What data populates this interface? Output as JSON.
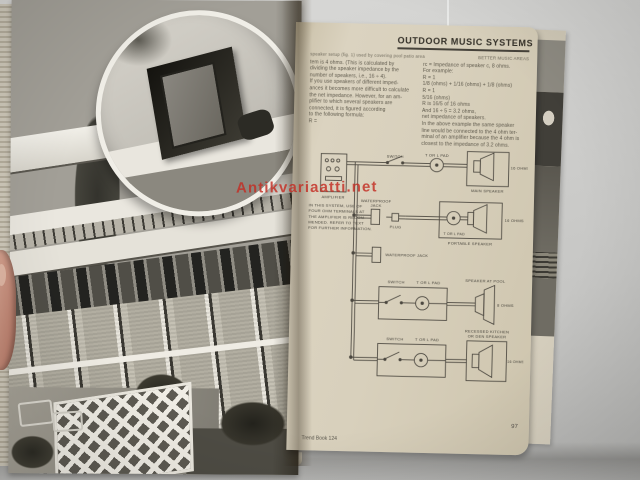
{
  "watermark": {
    "text": "Antikvariaatti.net",
    "color": "#c0352b"
  },
  "colors": {
    "paper": "#d8d0bc",
    "ink": "#4c4840",
    "photo_gray": "#a29f97",
    "backdrop": "#cdcdcb"
  },
  "right_page": {
    "title": "OUTDOOR MUSIC SYSTEMS",
    "caption_left": "speaker setup (fig. 1) used by covering pool patio area",
    "caption_right": "BETTER MUSIC AREAS",
    "col_left": [
      "tem is 4 ohms. (This is calculated by",
      "dividing the speaker impedance by the",
      "number of speakers, i.e., 16 ÷ 4).",
      "If you use speakers of different imped-",
      "ances it becomes more difficult to calculate",
      "the net impedance. However, for an am-",
      "plifier to which several speakers are",
      "connected, it is figured according",
      "to the following formula:",
      "R ="
    ],
    "col_right": [
      "rc = Impedance of speaker c, 8 ohms.",
      "For example:",
      "R =              1",
      "     1/8 (ohms) + 1/16 (ohms) + 1/8 (ohms)",
      "R =              1",
      "           5/16 (ohms)",
      "R is 16/5 of 16 ohms",
      "And 16 ÷ 5 = 3.2 ohms,",
      "net impedance of speakers.",
      "In the above example the same speaker",
      "line would be connected to the 4 ohm ter-",
      "minal of an amplifier because the 4 ohm is",
      "closest to the impedance of 3.2 ohms."
    ],
    "diagram": {
      "note_lines": [
        "IN THIS SYSTEM, USE OF",
        "FOUR OHM TERMINALS AT",
        "THE AMPLIFIER IS RECOM-",
        "MENDED. REFER TO TEXT",
        "FOR FURTHER INFORMATION."
      ],
      "amplifier": "AMPLIFIER",
      "switch": "SWITCH",
      "pad": "T OR L PAD",
      "main_speaker": "MAIN SPEAKER",
      "main_ohms": "16 OHMS",
      "jack_line1": "WATERPROOF",
      "jack_line2": "JACK",
      "jack": "WATERPROOF JACK",
      "plug": "PLUG",
      "portable_speaker": "PORTABLE SPEAKER",
      "portable_ohms": "16 OHMS",
      "pool_speaker": "SPEAKER AT POOL",
      "pool_ohms": "8 OHMS",
      "kitchen_speaker_1": "RECESSED KITCHEN",
      "kitchen_speaker_2": "OR DEN SPEAKER",
      "kitchen_ohms": "16 OHMS"
    },
    "footer": {
      "imprint": "Trend Book 124",
      "page_number": "97"
    }
  }
}
